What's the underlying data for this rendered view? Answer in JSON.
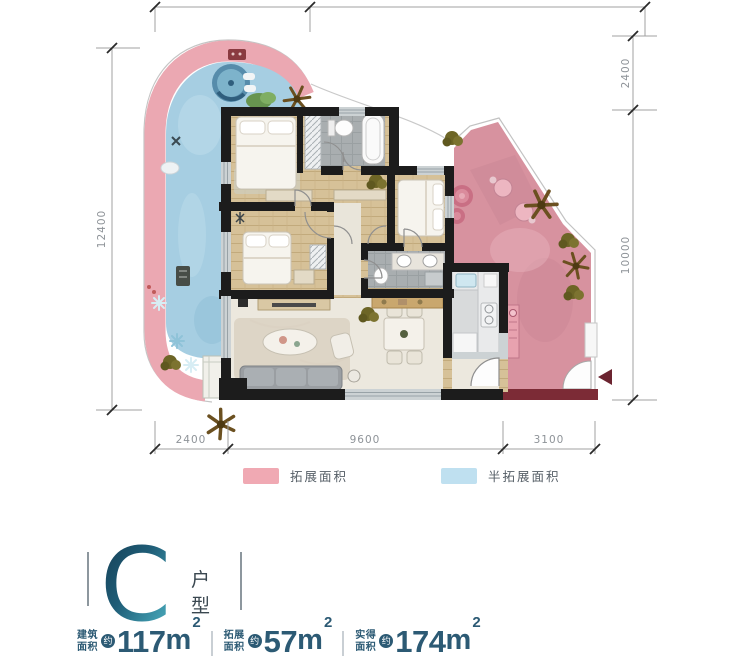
{
  "floor_plan": {
    "dimensions": {
      "left": "12400",
      "right": [
        "2400",
        "10000"
      ],
      "bottom": [
        "2400",
        "9600",
        "3100"
      ]
    },
    "legend": [
      {
        "label": "拓展面积",
        "color": "#f0a9b3"
      },
      {
        "label": "半拓展面积",
        "color": "#bfe0f0"
      }
    ]
  },
  "unit": {
    "letter": "C",
    "suffix": [
      "户",
      "型"
    ],
    "stats": [
      {
        "label": [
          "建筑",
          "面积"
        ],
        "approx": "约",
        "value": "117",
        "unit": "m",
        "power": "2"
      },
      {
        "label": [
          "拓展",
          "面积"
        ],
        "approx": "约",
        "value": "57",
        "unit": "m",
        "power": "2"
      },
      {
        "label": [
          "实得",
          "面积"
        ],
        "approx": "约",
        "value": "174",
        "unit": "m",
        "power": "2"
      }
    ]
  },
  "colors": {
    "expand_area": "#d7929f",
    "semi_expand_area": "#a6cee2",
    "wall": "#1c1c1c",
    "accent_text": "#2c5a74",
    "letter_gradient_start": "#14394f",
    "letter_gradient_end": "#57b0bd"
  }
}
